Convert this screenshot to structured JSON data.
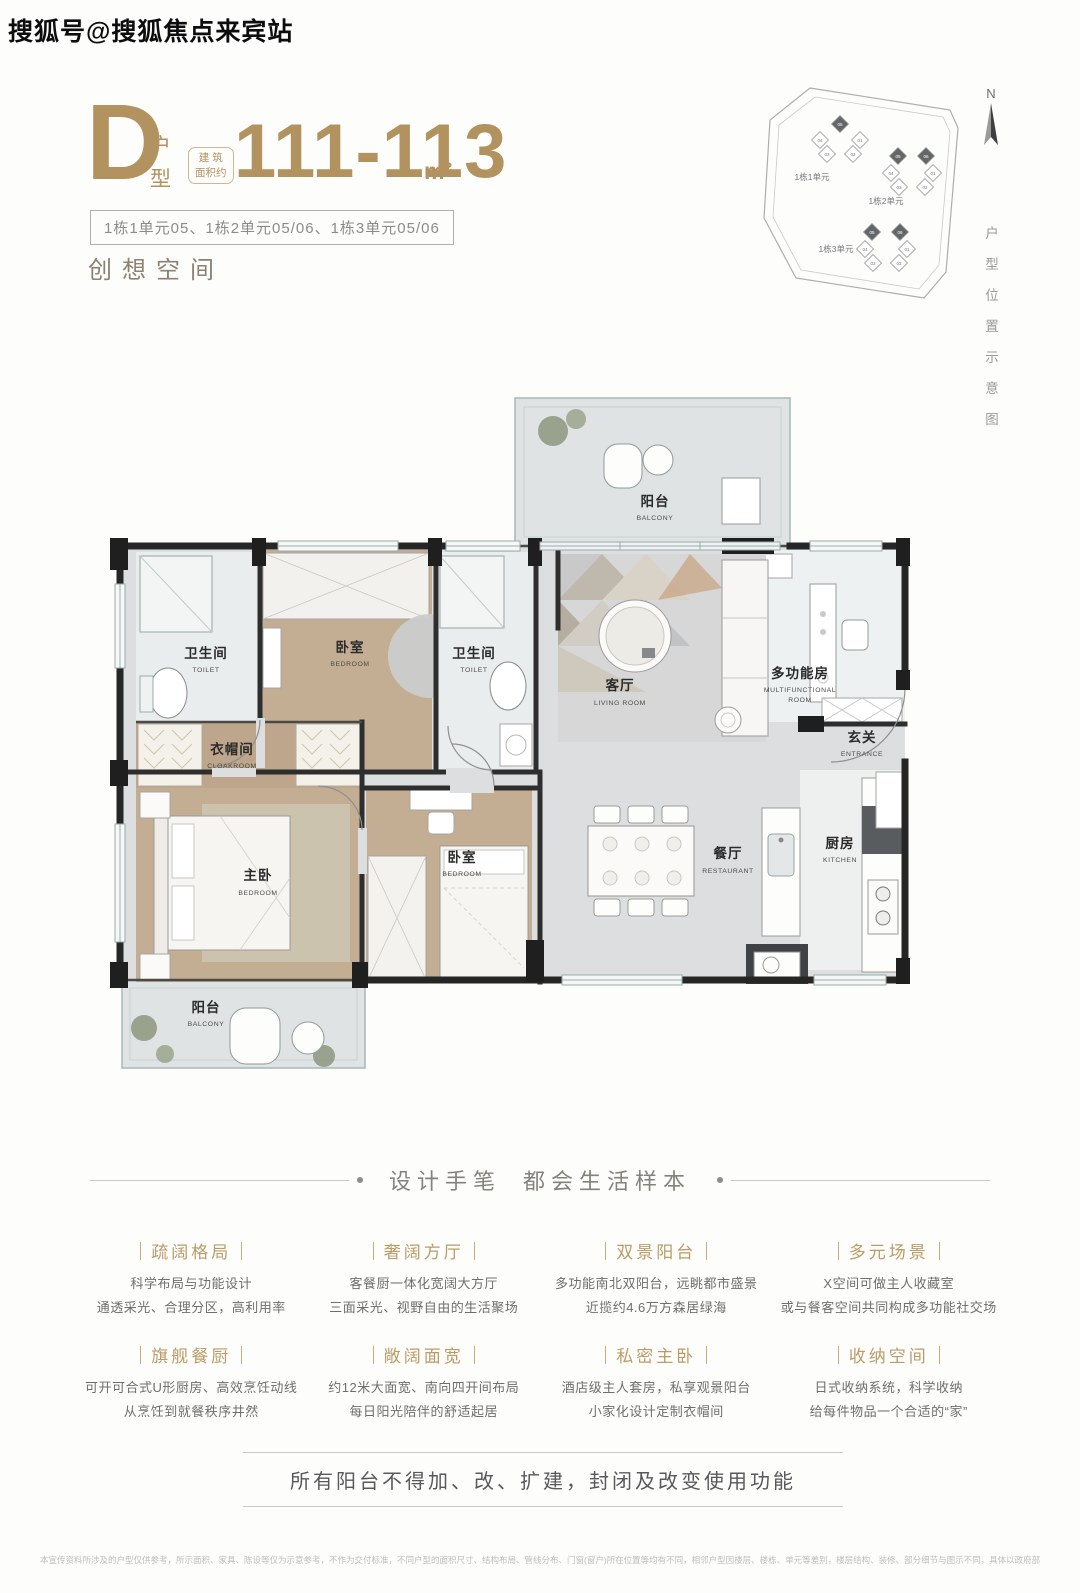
{
  "watermark": "搜狐号@搜狐焦点来宾站",
  "header": {
    "type_letter": "D",
    "type_label_char1": "户",
    "type_label_char2": "型",
    "area_note_line1": "建 筑",
    "area_note_line2": "面积约",
    "area_value": "111-113",
    "area_unit": "m²",
    "units_tag": "1栋1单元05、1栋2单元05/06、1栋3单元05/06",
    "slogan": "创想空间"
  },
  "siteplan": {
    "north_label": "N",
    "caption": "户型位置示意图",
    "clusters": [
      {
        "label": "1栋1单元",
        "units": [
          {
            "no": "05",
            "dark": true
          },
          {
            "no": "04",
            "dark": false
          },
          {
            "no": "01",
            "dark": false
          },
          {
            "no": "03",
            "dark": false
          },
          {
            "no": "02",
            "dark": false
          }
        ]
      },
      {
        "label": "1栋2单元",
        "units": [
          {
            "no": "05",
            "dark": true
          },
          {
            "no": "06",
            "dark": true
          },
          {
            "no": "04",
            "dark": false
          },
          {
            "no": "01",
            "dark": false
          },
          {
            "no": "03",
            "dark": false
          },
          {
            "no": "02",
            "dark": false
          }
        ]
      },
      {
        "label": "1栋3单元",
        "units": [
          {
            "no": "05",
            "dark": true
          },
          {
            "no": "06",
            "dark": true
          },
          {
            "no": "04",
            "dark": false
          },
          {
            "no": "01",
            "dark": false
          },
          {
            "no": "03",
            "dark": false
          },
          {
            "no": "02",
            "dark": false
          }
        ]
      }
    ]
  },
  "floorplan": {
    "rooms": [
      {
        "id": "balcony-top",
        "cn": "阳台",
        "en": "BALCONY"
      },
      {
        "id": "toilet-left",
        "cn": "卫生间",
        "en": "TOILET"
      },
      {
        "id": "bedroom-top",
        "cn": "卧室",
        "en": "BEDROOM"
      },
      {
        "id": "toilet-right",
        "cn": "卫生间",
        "en": "TOILET"
      },
      {
        "id": "living",
        "cn": "客厅",
        "en": "LIVING ROOM"
      },
      {
        "id": "multifunction",
        "cn": "多功能房",
        "en": "MULTIFUNCTIONAL",
        "en2": "ROOM"
      },
      {
        "id": "entrance",
        "cn": "玄关",
        "en": "ENTRANCE"
      },
      {
        "id": "cloakroom",
        "cn": "衣帽间",
        "en": "CLOAKROOM"
      },
      {
        "id": "master-bedroom",
        "cn": "主卧",
        "en": "BEDROOM"
      },
      {
        "id": "bedroom-bottom",
        "cn": "卧室",
        "en": "BEDROOM"
      },
      {
        "id": "dining",
        "cn": "餐厅",
        "en": "RESTAURANT"
      },
      {
        "id": "kitchen",
        "cn": "厨房",
        "en": "KITCHEN"
      },
      {
        "id": "balcony-bottom",
        "cn": "阳台",
        "en": "BALCONY"
      }
    ]
  },
  "section_title": {
    "part1": "设计手笔",
    "part2": "都会生活样本"
  },
  "features": [
    {
      "title": "疏阔格局",
      "line1": "科学布局与功能设计",
      "line2": "通透采光、合理分区，高利用率"
    },
    {
      "title": "奢阔方厅",
      "line1": "客餐厨一体化宽阔大方厅",
      "line2": "三面采光、视野自由的生活聚场"
    },
    {
      "title": "双景阳台",
      "line1": "多功能南北双阳台，远眺都市盛景",
      "line2": "近揽约4.6万方森居绿海"
    },
    {
      "title": "多元场景",
      "line1": "X空间可做主人收藏室",
      "line2": "或与餐客空间共同构成多功能社交场"
    },
    {
      "title": "旗舰餐厨",
      "line1": "可开可合式U形厨房、高效烹饪动线",
      "line2": "从烹饪到就餐秩序井然"
    },
    {
      "title": "敞阔面宽",
      "line1": "约12米大面宽、南向四开间布局",
      "line2": "每日阳光陪伴的舒适起居"
    },
    {
      "title": "私密主卧",
      "line1": "酒店级主人套房，私享观景阳台",
      "line2": "小家化设计定制衣帽间"
    },
    {
      "title": "收纳空间",
      "line1": "日式收纳系统，科学收纳",
      "line2": "给每件物品一个合适的“家”"
    }
  ],
  "notice": "所有阳台不得加、改、扩建，封闭及改变使用功能",
  "disclaimer": "本宣传资料所涉及的户型仅供参考，所示面积、家具、陈设等仅为示意参考，不作为交付标准，不同户型的面积尺寸、结构布局、管线分布、门窗(窗户)所在位置等均有不同，相邻户型因楼层、楼栋、单元等差别，楼层结构、装修、部分细节与图示不同，具体以政府部门最终审批的图纸和买卖合同为准。制作日期：2023年3月",
  "colors": {
    "accent_gold": "#b2925f",
    "feature_gold": "#bb9c68",
    "wall_dark": "#262626",
    "wood_floor": "#c3ad93",
    "marble_floor": "#dcdedf"
  }
}
